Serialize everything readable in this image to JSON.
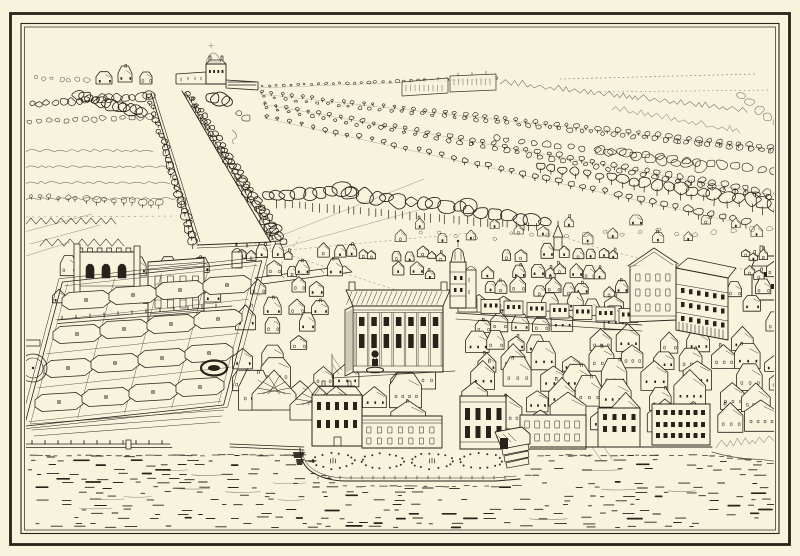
{
  "artwork": {
    "title": "Bird's-eye view engraving of a riverside palace with park, tree-lined canal, mall avenues and formal gardens beside a river",
    "palette": {
      "paper": "#f8f3dd",
      "ink": "#26231b",
      "faint": "#7c7560"
    },
    "frame": {
      "outer_rule": "thick single rule",
      "inner_rule": "double thin rule"
    },
    "features": {
      "park": {
        "canal_tree_rows": 2,
        "mall_avenue_rows": 4
      },
      "privy_garden": {
        "bed_rows": 4,
        "bed_columns": 4,
        "bed_shape": "rounded octagon with central plinth",
        "circular_fountain": 1,
        "oval_basin": 1
      },
      "riverside_parterre": {
        "oval_beds": 4
      },
      "river": {
        "texture": "short horizontal dash strokes"
      }
    }
  }
}
